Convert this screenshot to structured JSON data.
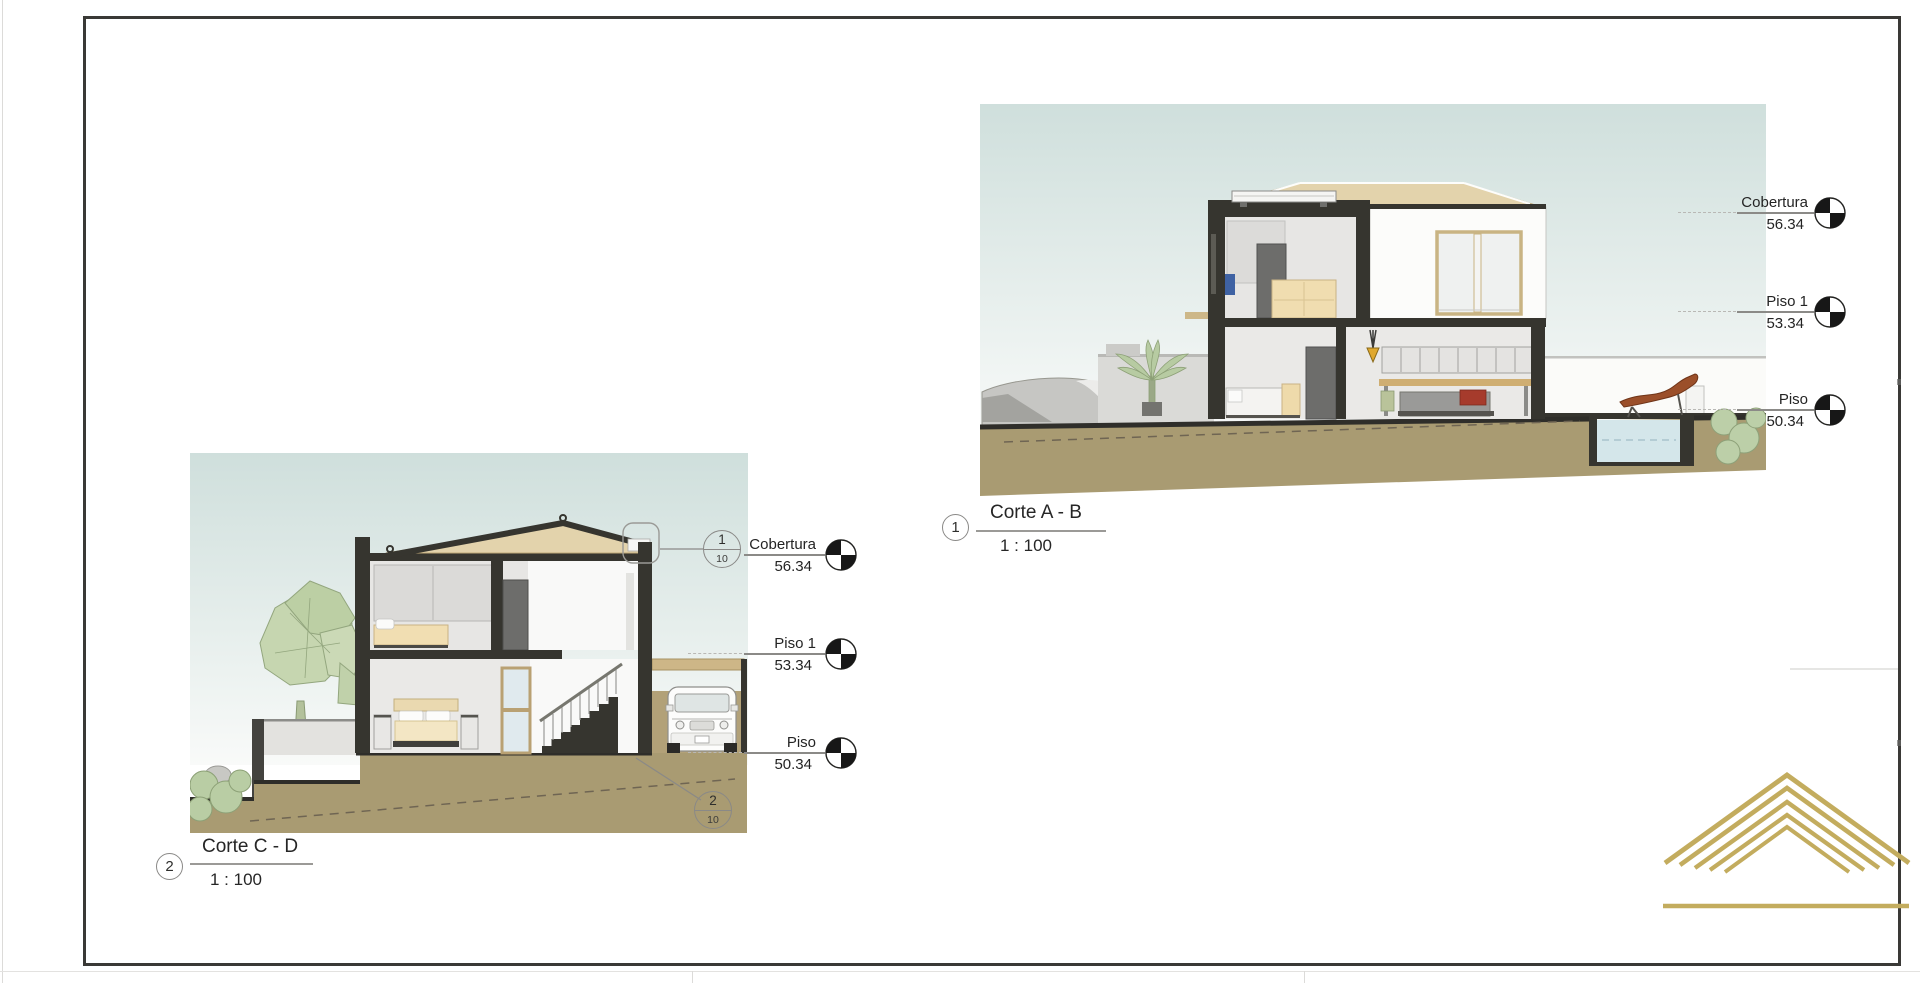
{
  "sheet": {
    "background": "#ffffff",
    "border_color": "#3a3936"
  },
  "levels": [
    {
      "label": "Cobertura",
      "value": "56.34"
    },
    {
      "label": "Piso 1",
      "value": "53.34"
    },
    {
      "label": "Piso",
      "value": "50.34"
    }
  ],
  "views": {
    "corte_ab": {
      "callout": "1",
      "title": "Corte A - B",
      "scale": "1 : 100"
    },
    "corte_cd": {
      "callout": "2",
      "title": "Corte C - D",
      "scale": "1 : 100"
    }
  },
  "detail_callouts": {
    "eave": {
      "detail": "1",
      "sheet": "10"
    },
    "footing": {
      "detail": "2",
      "sheet": "10"
    }
  },
  "colors": {
    "sky": "#cfdfdc",
    "ground": "#a99b72",
    "section_cut": "#36352f",
    "roof": "#e3d3ac",
    "glass": "#eff1f0",
    "water": "#d4e6ea",
    "vegetation": "#bfd1a9",
    "gold": "#c3ac5e",
    "annotation": "#8a8987",
    "text": "#262626"
  }
}
